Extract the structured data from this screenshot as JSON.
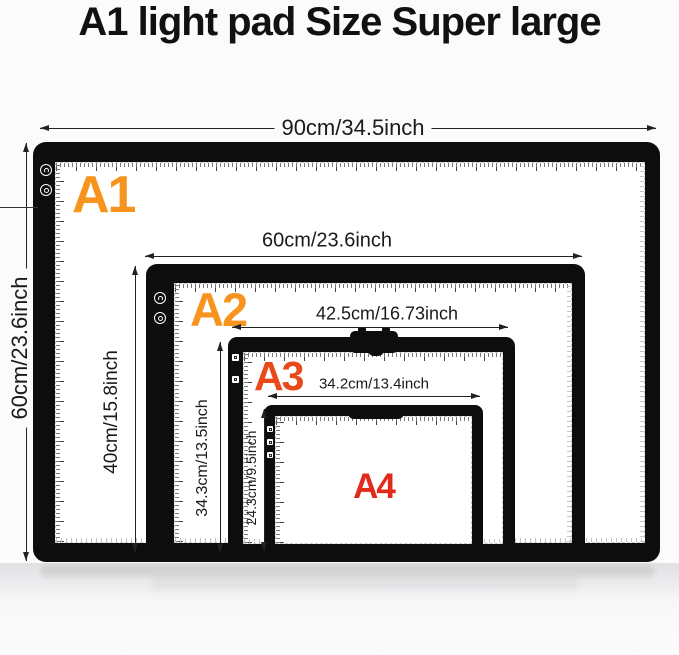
{
  "title": "A1 light pad Size Super large",
  "colors": {
    "a1_label": "#F7941E",
    "a2_label": "#F7941E",
    "a3_label": "#E94A1B",
    "a4_label": "#E3291A",
    "pad_frame": "#0d0d0d"
  },
  "pads": [
    {
      "id": "a1",
      "label": "A1",
      "width_dim": "90cm/34.5inch",
      "height_dim": "60cm/23.6inch"
    },
    {
      "id": "a2",
      "label": "A2",
      "width_dim": "60cm/23.6inch",
      "height_dim": "40cm/15.8inch"
    },
    {
      "id": "a3",
      "label": "A3",
      "width_dim": "42.5cm/16.73inch",
      "height_dim": "34.3cm/13.5inch"
    },
    {
      "id": "a4",
      "label": "A4",
      "width_dim": "34.2cm/13.4inch",
      "height_dim": "24.3cm/9.5inch"
    }
  ],
  "icons": {
    "power_button": "power-icon",
    "brightness_button": "brightness-icon",
    "touch_key": "touch-key-icon",
    "clip": "paper-clip-icon",
    "ruler": "ruler-scale"
  }
}
